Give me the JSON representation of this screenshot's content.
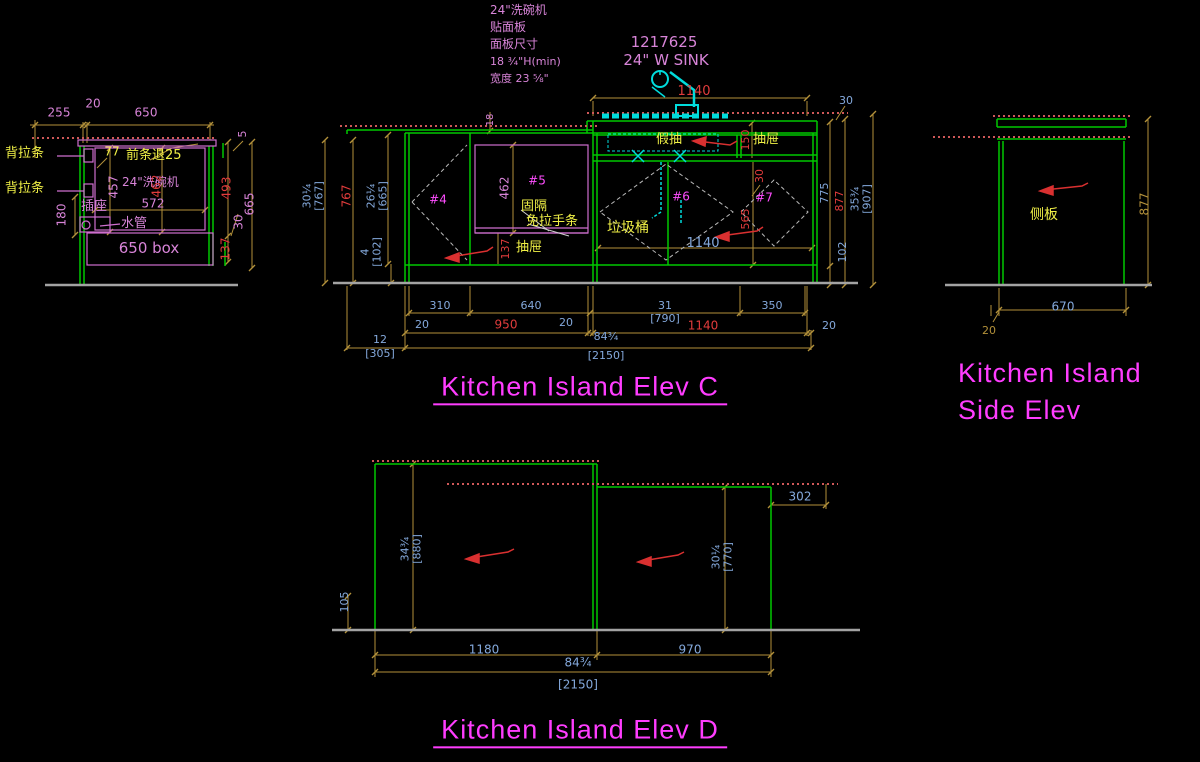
{
  "colors": {
    "background": "#000000",
    "structure_green": "#00c800",
    "structure_magenta": "#cf6fcf",
    "dim_line_olive": "#b3913a",
    "dim_text_blue": "#84a9dc",
    "dim_text_red": "#e23c3c",
    "dim_text_pink": "#d884d8",
    "label_yellow": "#f0f046",
    "title_magenta": "#ff3dff",
    "countertop_dotted_red": "#cf5858",
    "plumbing_cyan": "#00dcdc",
    "baseline_gray": "#a3a3a3"
  },
  "section": {
    "dims": {
      "d255": "255",
      "d20": "20",
      "d650": "650",
      "d5": "5",
      "d77": "77",
      "d457": "457",
      "d462": "462",
      "d572": "572",
      "d180": "180",
      "d493": "493",
      "d665": "665",
      "d30": "30",
      "d137": "137"
    },
    "labels": {
      "back_rail_1": "背拉条",
      "back_rail_2": "背拉条",
      "front_strip": "前条退25",
      "dishwasher": "24\"洗碗机",
      "socket": "插座",
      "water_pipe": "水管",
      "box": "650 box"
    }
  },
  "elev_c": {
    "notes": [
      "24\"洗碗机",
      "贴面板",
      "面板尺寸",
      "18 ¾\"H(min)",
      "宽度 23 ⅝\""
    ],
    "sink_code": "1217625",
    "sink_label": "24\" W SINK",
    "labels": {
      "fake_drawer": "假抽",
      "drawer_top": "抽屉",
      "fixed_divider": "固隔",
      "no_handle_strip": "免拉手条",
      "drawer_mid": "抽屉",
      "trash_bin": "垃圾桶",
      "c4": "#4",
      "c5": "#5",
      "c6": "#6",
      "c7": "#7"
    },
    "dims": {
      "top_1140": "1140",
      "top_30": "30",
      "t18": "18",
      "l767a": "30¼",
      "l767b": "[767]",
      "l767": "767",
      "l665a": "26¼",
      "l665b": "[665]",
      "l102a": "4",
      "l102b": "[102]",
      "c462": "462",
      "c137": "137",
      "r150": "150",
      "r30": "30",
      "r565": "565",
      "mid_1140": "1140",
      "r775": "775",
      "r877": "877",
      "r907a": "35¾",
      "r907b": "[907]",
      "r102": "102",
      "b310": "310",
      "b640": "640",
      "b31": "31",
      "b790": "[790]",
      "b350": "350",
      "b20a": "20",
      "b950": "950",
      "b20b": "20",
      "b1140": "1140",
      "b20c": "20",
      "b12": "12",
      "b305": "[305]",
      "b84": "84¾",
      "b2150": "[2150]"
    },
    "title": "Kitchen Island Elev C"
  },
  "side_elev": {
    "labels": {
      "side_panel": "侧板"
    },
    "dims": {
      "h877": "877",
      "w670": "670",
      "w20": "20"
    },
    "title1": "Kitchen Island",
    "title2": "Side Elev"
  },
  "elev_d": {
    "dims": {
      "l880a": "34¾",
      "l880b": "[880]",
      "r770a": "30¼",
      "r770b": "[770]",
      "r302": "302",
      "l105": "105",
      "b1180": "1180",
      "b970": "970",
      "b84": "84¾",
      "b2150": "[2150]"
    },
    "title": "Kitchen Island Elev D"
  }
}
